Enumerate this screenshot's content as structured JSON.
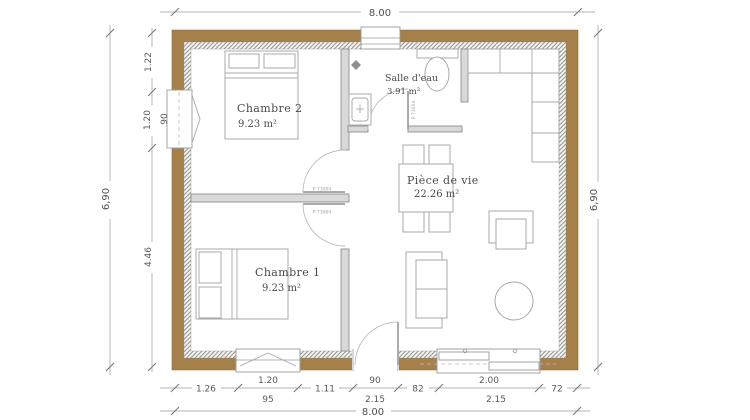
{
  "rooms": {
    "chambre2": {
      "name": "Chambre 2",
      "area": "9.23 m²"
    },
    "salle_deau": {
      "name": "Salle d'eau",
      "area": "3.91 m²"
    },
    "piece_de_vie": {
      "name": "Pièce de vie",
      "area": "22.26 m²"
    },
    "chambre1": {
      "name": "Chambre 1",
      "area": "9.23 m²"
    }
  },
  "dims": {
    "top_overall": "8.00",
    "bottom_overall": "8.00",
    "left_overall": "6,90",
    "right_overall": "6,90",
    "left_chain": {
      "seg1": "1.22",
      "seg2": "1.20",
      "window_h": "90",
      "seg3": "4.46"
    },
    "bottom_chain": {
      "seg1": "1.26",
      "seg2": "1.20",
      "seg3": "1.11",
      "seg4": "90",
      "seg5": "82",
      "seg6": "2.00",
      "seg7": "72"
    },
    "bottom_sub": {
      "window1_h": "95",
      "door_h": "2.15",
      "bay_h": "2.15"
    }
  },
  "labels": {
    "door_code": "P 73004"
  },
  "colors": {
    "wall_wood": "#a6804b",
    "hatch_line": "#8f8f8f",
    "dim_line": "#b3b3b3",
    "text": "#4a4a4a"
  }
}
